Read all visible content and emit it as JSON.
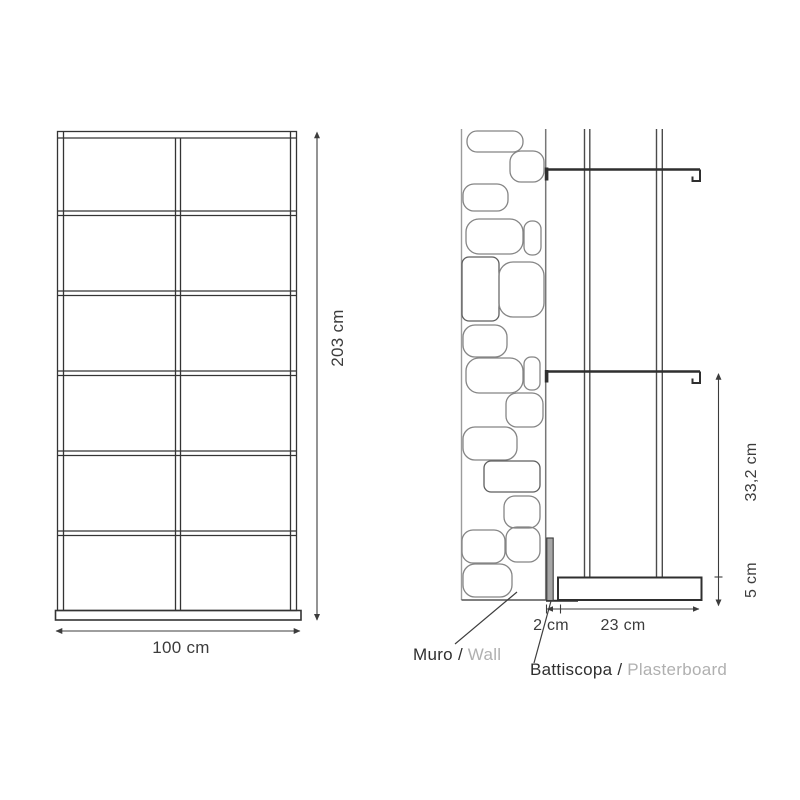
{
  "front_view": {
    "height_dim": "203 cm",
    "width_dim": "100 cm",
    "rows": 6,
    "columns": 2
  },
  "side_view": {
    "shelf_span_dim": "33,2 cm",
    "base_height_dim": "5 cm",
    "wall_gap_dim": "2 cm",
    "base_depth_dim": "23 cm",
    "wall_label": {
      "it": "Muro /",
      "en": "Wall"
    },
    "skirting_label": {
      "it": "Battiscopa /",
      "en": "Plasterboard"
    }
  },
  "colors": {
    "line": "#343434",
    "stone_outline": "#858585",
    "wall_line": "#9c9c9c",
    "secondary_text": "#b0b0b0",
    "skirting_fill": "#a6a6a6"
  }
}
